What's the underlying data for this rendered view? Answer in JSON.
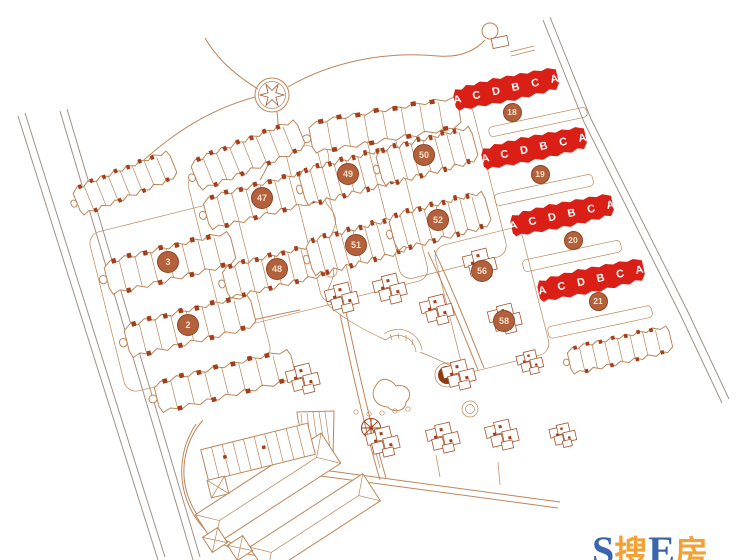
{
  "map": {
    "type": "residential-site-plan",
    "colors": {
      "background": "#ffffff",
      "line": "#bd8659",
      "line_dark": "#a3562f",
      "accent": "#a33d1a",
      "road": "#a39184",
      "highlight": "#da1f16",
      "unit_label": "#ffffff",
      "marker_fill": "#b2613c",
      "marker_border": "#8e4524",
      "marker_text": "#f6e0cd",
      "wm_blue": "#3a66ad",
      "wm_orange": "#f2a235"
    },
    "highlighted_buildings": [
      {
        "id": "18",
        "units": "A C D B C A",
        "x": 506,
        "y": 89,
        "width": 106,
        "height": 27,
        "rotation": -12,
        "marker_x": 512,
        "marker_y": 112
      },
      {
        "id": "19",
        "units": "A C D B C A",
        "x": 534,
        "y": 148,
        "width": 106,
        "height": 27,
        "rotation": -12,
        "marker_x": 540,
        "marker_y": 174
      },
      {
        "id": "20",
        "units": "A C D B C A",
        "x": 562,
        "y": 215,
        "width": 104,
        "height": 27,
        "rotation": -12,
        "marker_x": 573,
        "marker_y": 240
      },
      {
        "id": "21",
        "units": "A C D B C A",
        "x": 591,
        "y": 280,
        "width": 108,
        "height": 27,
        "rotation": -12,
        "marker_x": 598,
        "marker_y": 301
      }
    ],
    "numbered_markers": [
      {
        "id": "3",
        "x": 168,
        "y": 262
      },
      {
        "id": "2",
        "x": 188,
        "y": 325
      },
      {
        "id": "47",
        "x": 262,
        "y": 198
      },
      {
        "id": "48",
        "x": 277,
        "y": 269
      },
      {
        "id": "49",
        "x": 348,
        "y": 174
      },
      {
        "id": "50",
        "x": 424,
        "y": 155
      },
      {
        "id": "51",
        "x": 356,
        "y": 245
      },
      {
        "id": "52",
        "x": 438,
        "y": 220
      },
      {
        "id": "56",
        "x": 482,
        "y": 271
      },
      {
        "id": "58",
        "x": 504,
        "y": 321
      }
    ],
    "watermark": {
      "parts": [
        {
          "text": "S",
          "color_role": "blue"
        },
        {
          "text": "搜",
          "color_role": "orange"
        },
        {
          "text": "E",
          "color_role": "blue"
        },
        {
          "text": "房",
          "color_role": "orange"
        }
      ]
    }
  }
}
